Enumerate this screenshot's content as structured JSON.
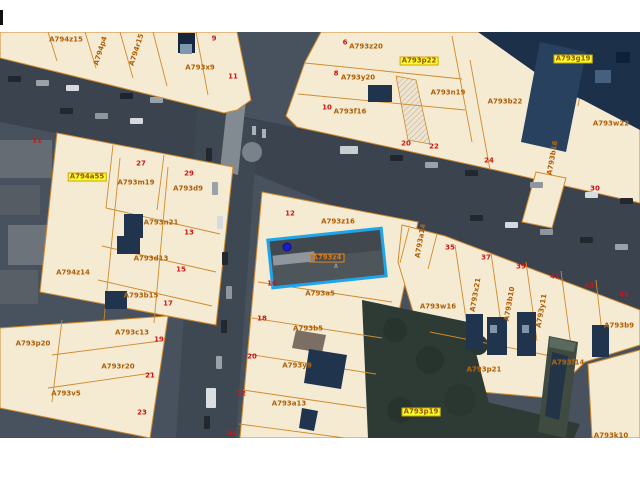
{
  "app": {
    "type": "gis-parcel-map-viewer"
  },
  "map": {
    "margins": {
      "top_px": 32,
      "bottom_px": 42
    },
    "colors": {
      "parcel_fill": "#f5ebd3",
      "parcel_line": "#d08a2e",
      "parcel_label_text": "#b05c00",
      "house_number_text": "#cc1515",
      "highlight_label_bg": "#fbff2e",
      "selection_border": "#1fa6ea",
      "marker_dot": "#1c1ccd",
      "aerial_base": "#48525e",
      "road": "#3a434e",
      "vegetation": "#2e3a34",
      "building": "#20344e"
    },
    "selected_parcel": {
      "label": "A793z4",
      "center_x": 327,
      "center_y": 258,
      "width": 114,
      "height": 48,
      "rotation_deg": -6
    },
    "marker_dot": {
      "x": 287,
      "y": 247
    },
    "labels": [
      {
        "text": "A794z15",
        "x": 66,
        "y": 40,
        "kind": "parcel"
      },
      {
        "text": "A794p4",
        "x": 101,
        "y": 51,
        "kind": "parcel",
        "rot": -72
      },
      {
        "text": "A794r15",
        "x": 137,
        "y": 50,
        "kind": "parcel",
        "rot": -72
      },
      {
        "text": "A793x9",
        "x": 200,
        "y": 68,
        "kind": "parcel"
      },
      {
        "text": "9",
        "x": 214,
        "y": 39,
        "kind": "number"
      },
      {
        "text": "11",
        "x": 233,
        "y": 77,
        "kind": "number"
      },
      {
        "text": "6",
        "x": 345,
        "y": 43,
        "kind": "number"
      },
      {
        "text": "A793z20",
        "x": 366,
        "y": 47,
        "kind": "parcel"
      },
      {
        "text": "A793p22",
        "x": 419,
        "y": 61,
        "kind": "highlight"
      },
      {
        "text": "8",
        "x": 336,
        "y": 74,
        "kind": "number"
      },
      {
        "text": "A793y20",
        "x": 358,
        "y": 78,
        "kind": "parcel"
      },
      {
        "text": "10",
        "x": 327,
        "y": 108,
        "kind": "number"
      },
      {
        "text": "A793f16",
        "x": 350,
        "y": 112,
        "kind": "parcel"
      },
      {
        "text": "A793g19",
        "x": 573,
        "y": 59,
        "kind": "highlight"
      },
      {
        "text": "A793n19",
        "x": 448,
        "y": 93,
        "kind": "parcel"
      },
      {
        "text": "A793b22",
        "x": 505,
        "y": 102,
        "kind": "parcel"
      },
      {
        "text": "A793w22",
        "x": 611,
        "y": 124,
        "kind": "parcel"
      },
      {
        "text": "11",
        "x": 37,
        "y": 141,
        "kind": "number"
      },
      {
        "text": "20",
        "x": 406,
        "y": 144,
        "kind": "number"
      },
      {
        "text": "22",
        "x": 434,
        "y": 147,
        "kind": "number"
      },
      {
        "text": "24",
        "x": 489,
        "y": 161,
        "kind": "number"
      },
      {
        "text": "A793b16",
        "x": 553,
        "y": 158,
        "kind": "parcel",
        "rot": -80
      },
      {
        "text": "30",
        "x": 595,
        "y": 189,
        "kind": "number"
      },
      {
        "text": "A794a55",
        "x": 87,
        "y": 177,
        "kind": "highlight"
      },
      {
        "text": "27",
        "x": 141,
        "y": 164,
        "kind": "number"
      },
      {
        "text": "A793m19",
        "x": 136,
        "y": 183,
        "kind": "parcel"
      },
      {
        "text": "29",
        "x": 189,
        "y": 174,
        "kind": "number"
      },
      {
        "text": "A793d9",
        "x": 188,
        "y": 189,
        "kind": "parcel"
      },
      {
        "text": "A793n21",
        "x": 161,
        "y": 223,
        "kind": "parcel"
      },
      {
        "text": "13",
        "x": 189,
        "y": 233,
        "kind": "number"
      },
      {
        "text": "A793d13",
        "x": 151,
        "y": 259,
        "kind": "parcel"
      },
      {
        "text": "15",
        "x": 181,
        "y": 270,
        "kind": "number"
      },
      {
        "text": "A794z14",
        "x": 73,
        "y": 273,
        "kind": "parcel"
      },
      {
        "text": "A793b15",
        "x": 141,
        "y": 296,
        "kind": "parcel"
      },
      {
        "text": "17",
        "x": 168,
        "y": 304,
        "kind": "number"
      },
      {
        "text": "12",
        "x": 290,
        "y": 214,
        "kind": "number"
      },
      {
        "text": "A793z16",
        "x": 338,
        "y": 222,
        "kind": "parcel"
      },
      {
        "text": "A793z4",
        "x": 327,
        "y": 258,
        "kind": "selected"
      },
      {
        "text": "Δ",
        "x": 336,
        "y": 267,
        "kind": "tiny"
      },
      {
        "text": "16",
        "x": 272,
        "y": 284,
        "kind": "number"
      },
      {
        "text": "A793a5",
        "x": 320,
        "y": 294,
        "kind": "parcel"
      },
      {
        "text": "A793a14",
        "x": 421,
        "y": 241,
        "kind": "parcel",
        "rot": -80
      },
      {
        "text": "35",
        "x": 450,
        "y": 248,
        "kind": "number"
      },
      {
        "text": "37",
        "x": 486,
        "y": 258,
        "kind": "number"
      },
      {
        "text": "39",
        "x": 521,
        "y": 267,
        "kind": "number"
      },
      {
        "text": "41",
        "x": 555,
        "y": 277,
        "kind": "number"
      },
      {
        "text": "43",
        "x": 589,
        "y": 286,
        "kind": "number"
      },
      {
        "text": "45",
        "x": 624,
        "y": 295,
        "kind": "number"
      },
      {
        "text": "A793x21",
        "x": 476,
        "y": 295,
        "kind": "parcel",
        "rot": -80
      },
      {
        "text": "A793b10",
        "x": 510,
        "y": 304,
        "kind": "parcel",
        "rot": -80
      },
      {
        "text": "A793y11",
        "x": 542,
        "y": 311,
        "kind": "parcel",
        "rot": -80
      },
      {
        "text": "A793w16",
        "x": 438,
        "y": 307,
        "kind": "parcel"
      },
      {
        "text": "A793b9",
        "x": 619,
        "y": 326,
        "kind": "parcel"
      },
      {
        "text": "A793c13",
        "x": 132,
        "y": 333,
        "kind": "parcel"
      },
      {
        "text": "19",
        "x": 159,
        "y": 340,
        "kind": "number"
      },
      {
        "text": "A793p20",
        "x": 33,
        "y": 344,
        "kind": "parcel"
      },
      {
        "text": "A793r20",
        "x": 118,
        "y": 367,
        "kind": "parcel"
      },
      {
        "text": "21",
        "x": 150,
        "y": 376,
        "kind": "number"
      },
      {
        "text": "A793v5",
        "x": 66,
        "y": 394,
        "kind": "parcel"
      },
      {
        "text": "23",
        "x": 142,
        "y": 413,
        "kind": "number"
      },
      {
        "text": "18",
        "x": 262,
        "y": 319,
        "kind": "number"
      },
      {
        "text": "A793b5",
        "x": 308,
        "y": 329,
        "kind": "parcel"
      },
      {
        "text": "20",
        "x": 252,
        "y": 357,
        "kind": "number"
      },
      {
        "text": "A793y9",
        "x": 297,
        "y": 366,
        "kind": "parcel"
      },
      {
        "text": "22",
        "x": 241,
        "y": 394,
        "kind": "number"
      },
      {
        "text": "A793a13",
        "x": 289,
        "y": 404,
        "kind": "parcel"
      },
      {
        "text": "24",
        "x": 232,
        "y": 434,
        "kind": "number"
      },
      {
        "text": "A793p21",
        "x": 484,
        "y": 370,
        "kind": "parcel"
      },
      {
        "text": "A793f14",
        "x": 568,
        "y": 363,
        "kind": "parcel"
      },
      {
        "text": "A793p19",
        "x": 421,
        "y": 412,
        "kind": "highlight"
      },
      {
        "text": "A793k10",
        "x": 611,
        "y": 436,
        "kind": "parcel"
      }
    ]
  }
}
